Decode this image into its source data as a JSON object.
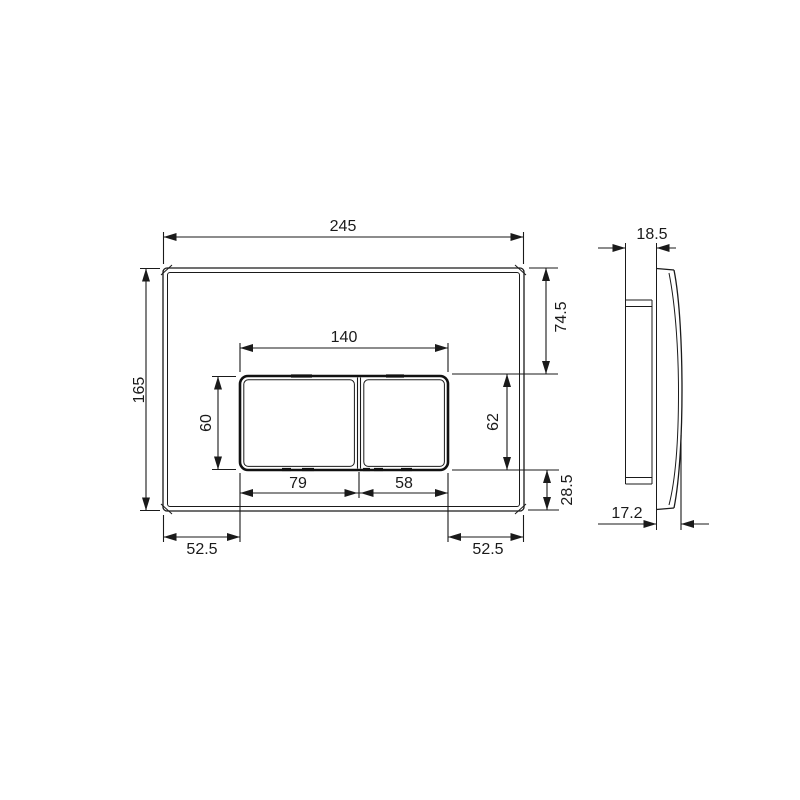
{
  "drawing": {
    "type": "technical-dimension-drawing",
    "subject": "wc-flush-plate-two-buttons",
    "views": [
      "front",
      "side"
    ],
    "units_shown": "mm",
    "line_color": "#1a1a1a",
    "background_color": "#ffffff"
  },
  "dims": {
    "plate_width": "245",
    "plate_height": "165",
    "buttons_group_width": "140",
    "button_left_height": "60",
    "button_right_height": "62",
    "top_to_buttons": "74.5",
    "buttons_to_bottom": "28.5",
    "button_left_width": "79",
    "button_right_width": "58",
    "margin_left": "52.5",
    "margin_right": "52.5",
    "side_depth_total": "18.5",
    "side_depth_cover": "17.2"
  }
}
